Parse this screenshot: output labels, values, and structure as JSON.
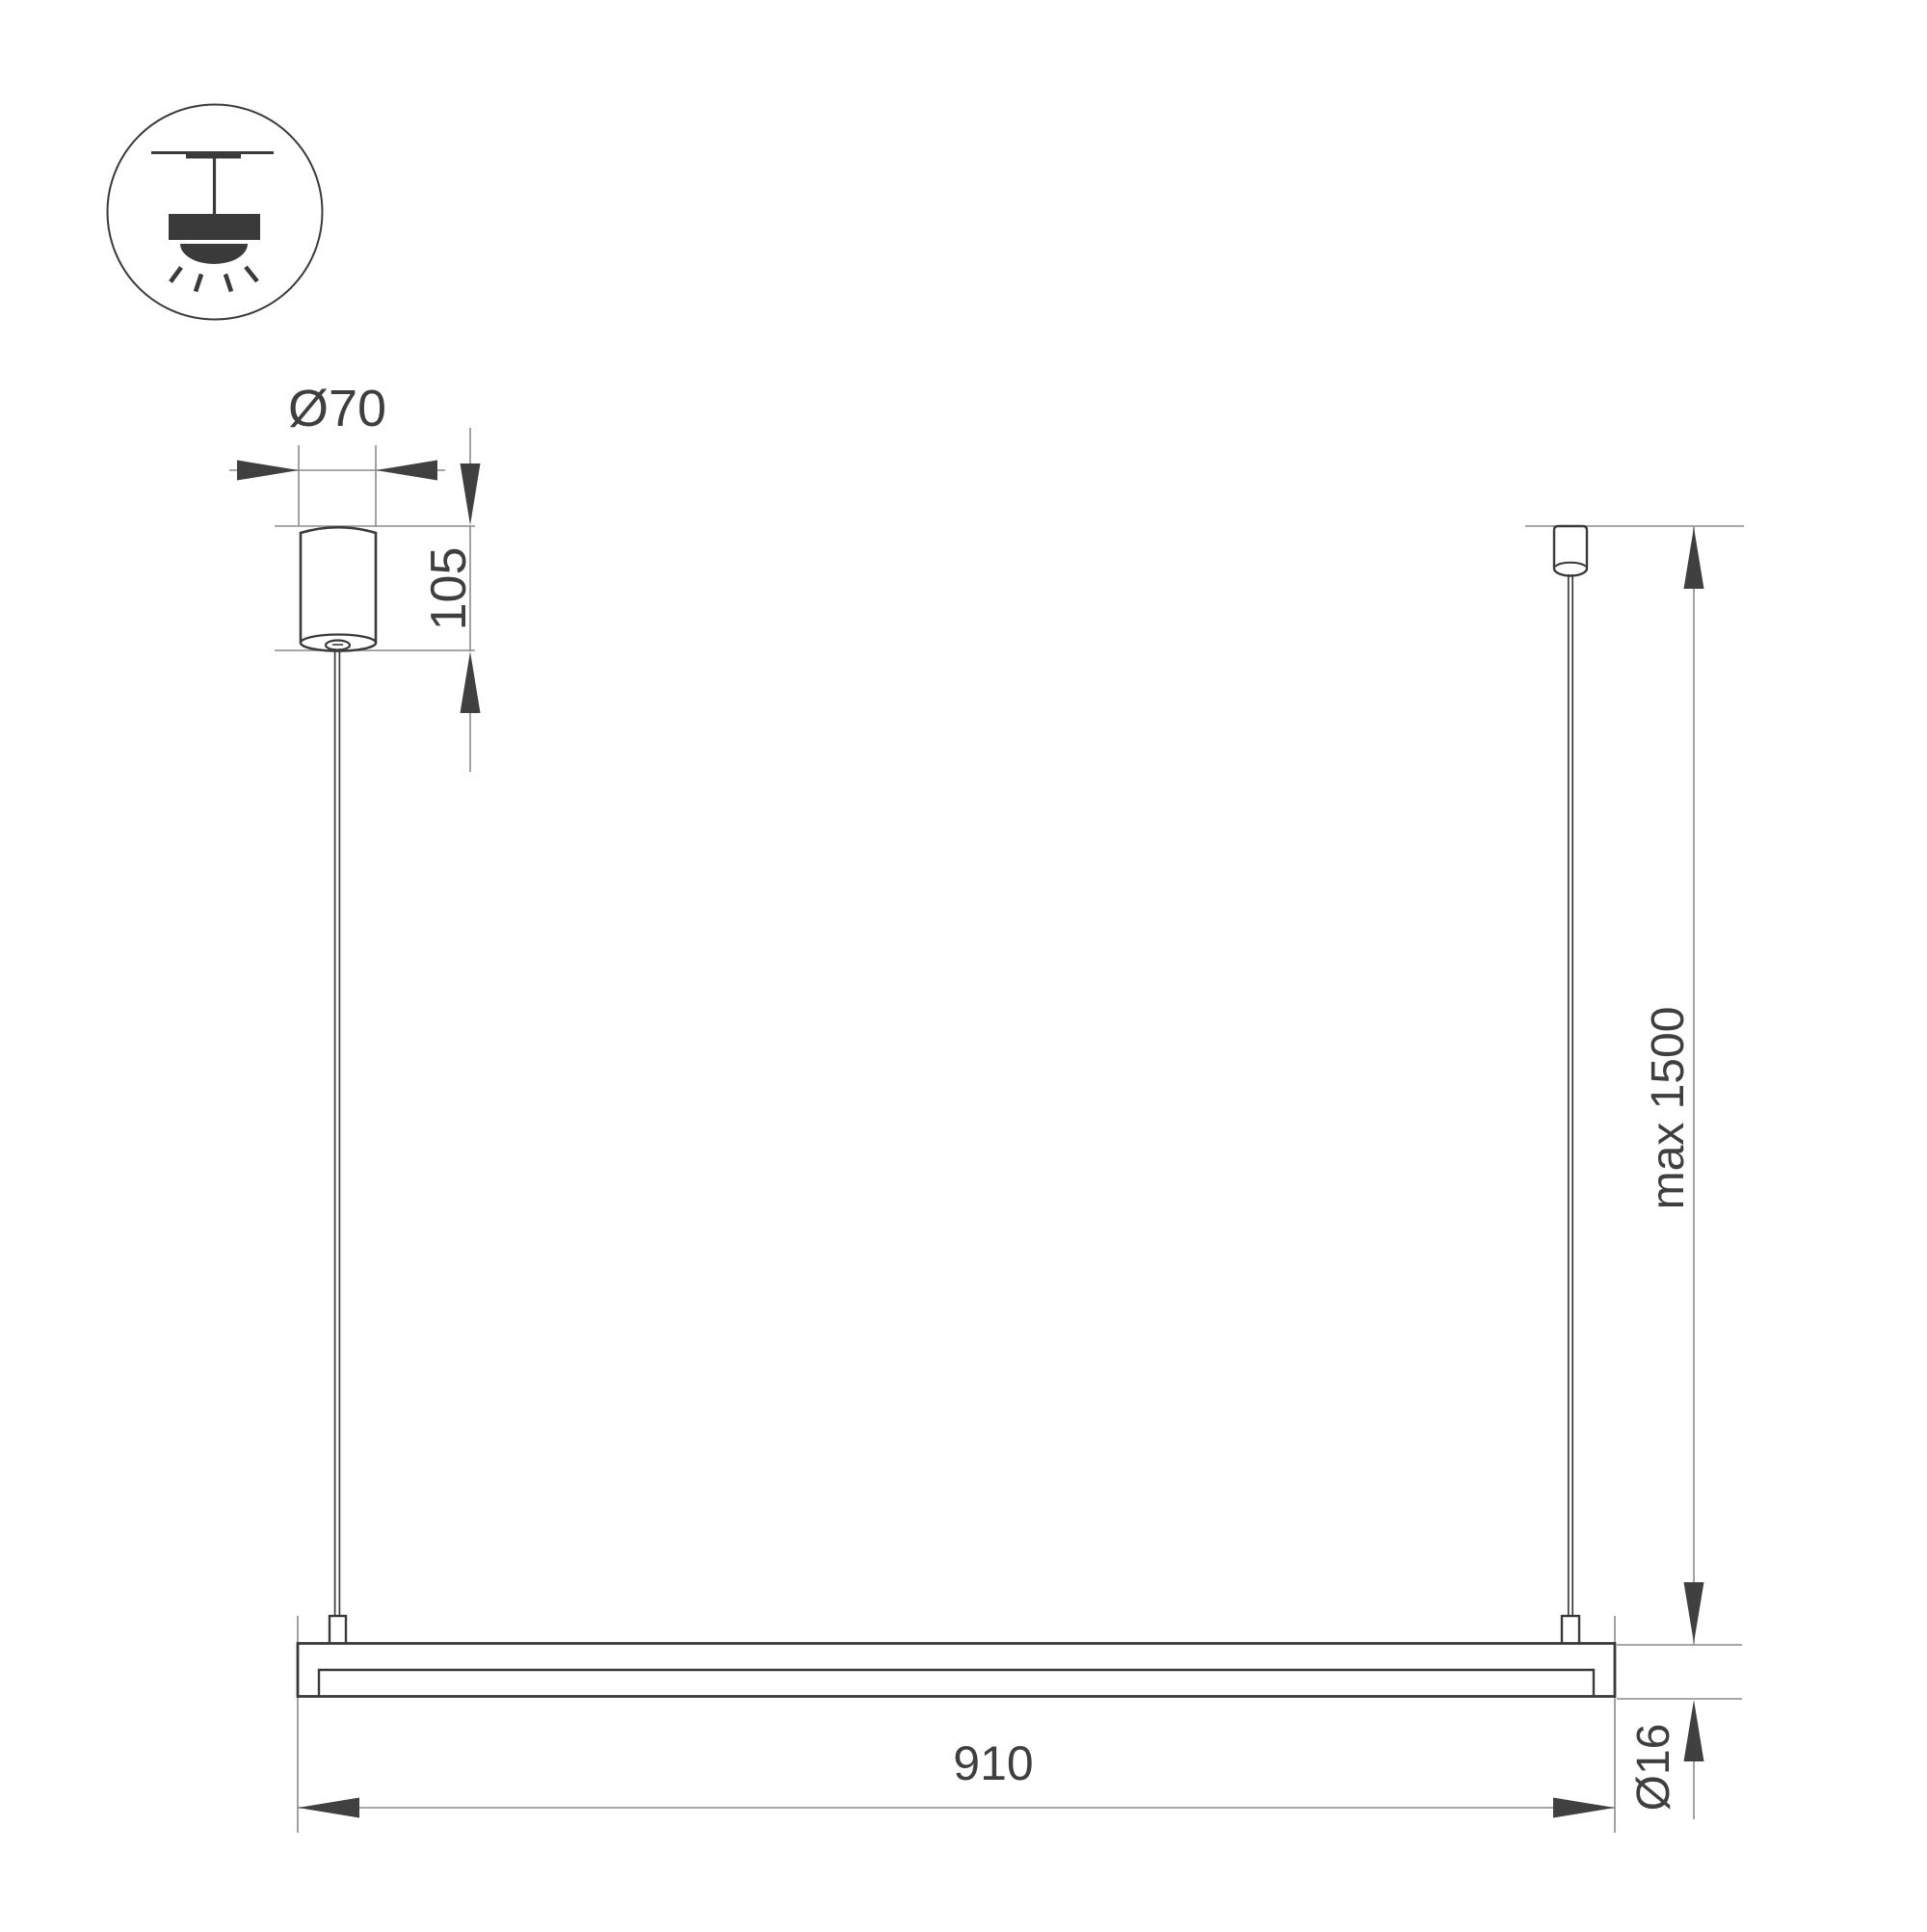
{
  "drawing": {
    "title": "pendant-linear-luminaire-installation-dimension-drawing",
    "labels": {
      "canopy_diameter": "Ø70",
      "canopy_height": "105",
      "suspension_max": "max 1500",
      "fixture_length": "910",
      "fixture_diameter": "Ø16"
    },
    "icon": "ceiling-pendant-mount-icon",
    "colors": {
      "background": "#ffffff",
      "outline": "#3a3a3a",
      "dimension_line": "#8a8a8a",
      "arrow": "#404040",
      "text": "#3f3f3f"
    }
  }
}
